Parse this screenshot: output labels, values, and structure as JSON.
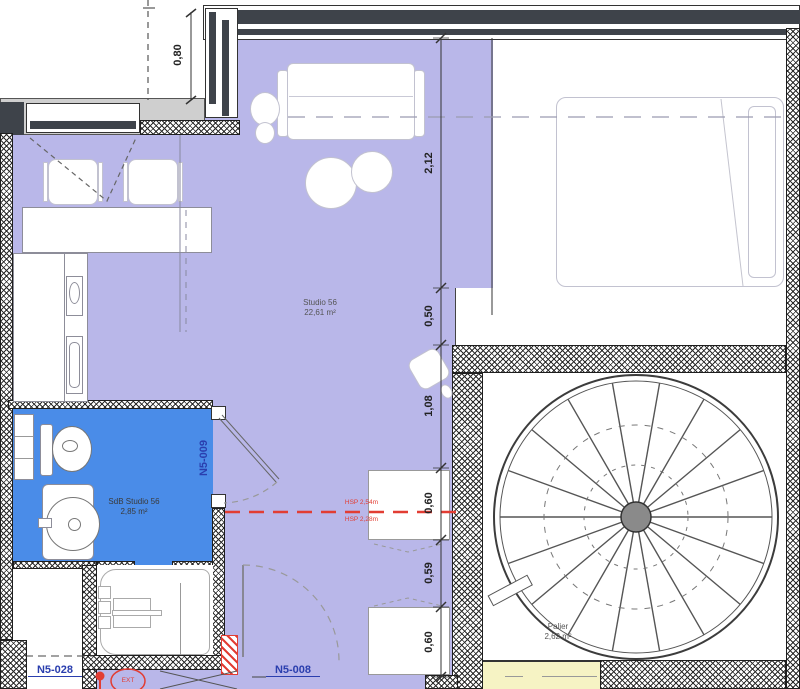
{
  "plan": {
    "rooms": {
      "studio": {
        "name": "Studio 56",
        "area": "22,61 m²"
      },
      "bathroom": {
        "name": "SdB Studio 56",
        "area": "2,85 m²"
      },
      "landing": {
        "name": "Palier",
        "area": "2,62 m²"
      }
    },
    "door_labels": {
      "bathroom_door": "N5-009",
      "left_unit": "N5-028",
      "entry_door": "N5-008"
    },
    "annotations": {
      "hsp_upper": "HSP 2,54m",
      "hsp_lower": "HSP 2,28m",
      "ext_marker": "EXT"
    },
    "dimensions": {
      "top_left": "0,80",
      "chain": [
        "2,12",
        "0,50",
        "1,08",
        "0,60",
        "0,59",
        "0,60"
      ]
    },
    "colors": {
      "floor": "#b9b7e9",
      "bathroom": "#4a8ce8",
      "landing_lower": "#f6f3c4",
      "alert_red": "#e23d33",
      "door_label_blue": "#2a3eae",
      "glazing_dark": "#3e434a"
    }
  }
}
